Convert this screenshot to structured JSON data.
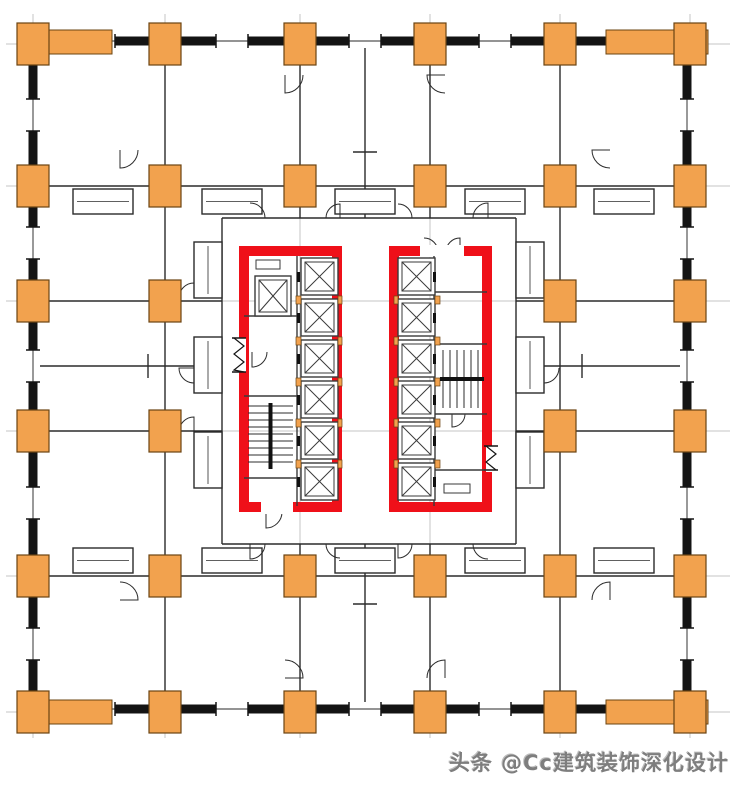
{
  "watermark": {
    "text": "头条 @Cc建筑装饰深化设计"
  },
  "colors": {
    "bg": "#ffffff",
    "wall": "#141414",
    "partition": "#2b2b2b",
    "grid": "#c6c6c6",
    "column_fill": "#f2a24e",
    "column_stroke": "#6b4412",
    "core_red": "#ef1019",
    "detail": "#3a3a3a",
    "stair": "#2e2e2e",
    "watermark_gray": "#7e7e7e"
  },
  "canvas": {
    "w": 734,
    "h": 787
  },
  "grid": {
    "x": [
      33,
      165,
      300,
      430,
      560,
      690
    ],
    "y": [
      44,
      186,
      301,
      431,
      576,
      712
    ],
    "x_extent": [
      6,
      730
    ],
    "y_extent": [
      14,
      738
    ]
  },
  "plan": {
    "outer_wall": {
      "rect": [
        33,
        41,
        654,
        668
      ],
      "thickness": 9
    },
    "windows_h": {
      "xs": [
        99,
        232,
        365,
        495,
        624
      ],
      "y_top": 41,
      "y_bottom": 709,
      "len": 32
    },
    "windows_v": {
      "ys": [
        115,
        243,
        366,
        503,
        644
      ],
      "x_left": 33,
      "x_right": 687,
      "len": 32
    },
    "corner_strips": [
      [
        20,
        30,
        92,
        24
      ],
      [
        606,
        30,
        102,
        24
      ],
      [
        20,
        700,
        92,
        24
      ],
      [
        606,
        700,
        102,
        24
      ]
    ],
    "column_size": [
      32,
      42
    ],
    "columns": [
      [
        165,
        44
      ],
      [
        300,
        44
      ],
      [
        430,
        44
      ],
      [
        560,
        44
      ],
      [
        165,
        712
      ],
      [
        300,
        712
      ],
      [
        430,
        712
      ],
      [
        560,
        712
      ],
      [
        33,
        186
      ],
      [
        33,
        301
      ],
      [
        33,
        431
      ],
      [
        33,
        576
      ],
      [
        690,
        186
      ],
      [
        690,
        301
      ],
      [
        690,
        431
      ],
      [
        690,
        576
      ],
      [
        33,
        44
      ],
      [
        690,
        44
      ],
      [
        33,
        712
      ],
      [
        690,
        712
      ],
      [
        165,
        186
      ],
      [
        300,
        186
      ],
      [
        430,
        186
      ],
      [
        560,
        186
      ],
      [
        165,
        301
      ],
      [
        560,
        301
      ],
      [
        165,
        431
      ],
      [
        560,
        431
      ],
      [
        165,
        576
      ],
      [
        300,
        576
      ],
      [
        430,
        576
      ],
      [
        560,
        576
      ]
    ],
    "partitions": [
      [
        165,
        46,
        165,
        708
      ],
      [
        560,
        46,
        560,
        708
      ],
      [
        300,
        46,
        300,
        218
      ],
      [
        430,
        46,
        430,
        218
      ],
      [
        365,
        46,
        365,
        218
      ],
      [
        300,
        544,
        300,
        708
      ],
      [
        430,
        544,
        430,
        708
      ],
      [
        365,
        544,
        365,
        708
      ],
      [
        36,
        186,
        688,
        186
      ],
      [
        36,
        576,
        688,
        576
      ],
      [
        36,
        301,
        222,
        301
      ],
      [
        36,
        366,
        222,
        366
      ],
      [
        36,
        431,
        222,
        431
      ],
      [
        516,
        301,
        688,
        301
      ],
      [
        516,
        366,
        688,
        366
      ],
      [
        516,
        431,
        688,
        431
      ],
      [
        222,
        218,
        516,
        218
      ],
      [
        222,
        544,
        516,
        544
      ],
      [
        222,
        218,
        222,
        544
      ],
      [
        516,
        218,
        516,
        544
      ],
      [
        353,
        152,
        377,
        152
      ],
      [
        353,
        604,
        377,
        604
      ],
      [
        148,
        354,
        148,
        378
      ],
      [
        582,
        354,
        582,
        378
      ]
    ],
    "pods": [
      [
        73,
        189,
        60,
        25
      ],
      [
        202,
        189,
        60,
        25
      ],
      [
        335,
        189,
        60,
        25
      ],
      [
        465,
        189,
        60,
        25
      ],
      [
        594,
        189,
        60,
        25
      ],
      [
        73,
        548,
        60,
        25
      ],
      [
        202,
        548,
        60,
        25
      ],
      [
        335,
        548,
        60,
        25
      ],
      [
        465,
        548,
        60,
        25
      ],
      [
        594,
        548,
        60,
        25
      ],
      [
        194,
        242,
        28,
        56
      ],
      [
        194,
        337,
        28,
        56
      ],
      [
        194,
        432,
        28,
        56
      ],
      [
        516,
        242,
        28,
        56
      ],
      [
        516,
        337,
        28,
        56
      ],
      [
        516,
        432,
        28,
        56
      ]
    ],
    "door_arcs": [
      [
        250,
        218,
        15,
        0
      ],
      [
        340,
        218,
        14,
        90
      ],
      [
        398,
        218,
        14,
        0
      ],
      [
        488,
        218,
        15,
        90
      ],
      [
        250,
        544,
        15,
        270
      ],
      [
        340,
        544,
        14,
        180
      ],
      [
        398,
        544,
        14,
        270
      ],
      [
        488,
        544,
        15,
        180
      ],
      [
        194,
        298,
        15,
        90
      ],
      [
        194,
        368,
        15,
        180
      ],
      [
        194,
        432,
        15,
        90
      ],
      [
        544,
        298,
        15,
        0
      ],
      [
        544,
        368,
        15,
        270
      ],
      [
        544,
        432,
        15,
        0
      ],
      [
        266,
        512,
        16,
        270
      ],
      [
        424,
        252,
        14,
        0
      ],
      [
        460,
        252,
        14,
        90
      ],
      [
        252,
        352,
        15,
        270
      ],
      [
        452,
        414,
        13,
        270
      ],
      [
        285,
        75,
        18,
        270
      ],
      [
        445,
        75,
        18,
        180
      ],
      [
        120,
        150,
        18,
        270
      ],
      [
        610,
        150,
        18,
        180
      ],
      [
        120,
        600,
        18,
        0
      ],
      [
        610,
        600,
        18,
        90
      ],
      [
        285,
        678,
        18,
        0
      ],
      [
        445,
        678,
        18,
        90
      ]
    ],
    "cores": [
      {
        "name": "left-core",
        "rect": [
          244,
          251,
          93,
          256
        ],
        "inner_lines": [
          [
            297,
            256,
            297,
            506
          ],
          [
            244,
            316,
            297,
            316
          ],
          [
            244,
            396,
            297,
            396
          ],
          [
            244,
            478,
            297,
            478
          ]
        ],
        "gaps": [
          [
            233,
            338,
            13,
            34
          ],
          [
            261,
            501,
            32,
            13
          ]
        ],
        "squiggles": [
          [
            239,
            338,
            239,
            372,
            "v"
          ]
        ],
        "elevators": [
          [
            255,
            276,
            36,
            40
          ],
          [
            301,
            258,
            37,
            37
          ],
          [
            301,
            299,
            37,
            37
          ],
          [
            301,
            340,
            37,
            37
          ],
          [
            301,
            381,
            37,
            37
          ],
          [
            301,
            422,
            37,
            37
          ],
          [
            301,
            463,
            37,
            37
          ]
        ],
        "separators": [
          [
            296,
            296,
            5,
            8
          ],
          [
            296,
            337,
            5,
            8
          ],
          [
            296,
            378,
            5,
            8
          ],
          [
            296,
            419,
            5,
            8
          ],
          [
            296,
            460,
            5,
            8
          ],
          [
            338,
            296,
            4,
            8
          ],
          [
            338,
            337,
            4,
            8
          ],
          [
            338,
            378,
            4,
            8
          ],
          [
            338,
            419,
            4,
            8
          ],
          [
            338,
            460,
            4,
            8
          ]
        ],
        "ticks": [
          [
            297,
            272,
            3,
            10
          ],
          [
            297,
            313,
            3,
            10
          ],
          [
            297,
            354,
            3,
            10
          ],
          [
            297,
            395,
            3,
            10
          ],
          [
            297,
            436,
            3,
            10
          ],
          [
            297,
            477,
            3,
            10
          ]
        ],
        "vents": [
          [
            256,
            260,
            24,
            9
          ]
        ],
        "stair": [
          246,
          400,
          49,
          72,
          "v"
        ]
      },
      {
        "name": "right-core",
        "rect": [
          394,
          251,
          93,
          256
        ],
        "inner_lines": [
          [
            434,
            256,
            434,
            506
          ],
          [
            434,
            292,
            487,
            292
          ],
          [
            434,
            344,
            487,
            344
          ],
          [
            434,
            414,
            487,
            414
          ],
          [
            434,
            470,
            487,
            470
          ]
        ],
        "gaps": [
          [
            420,
            245,
            44,
            12
          ],
          [
            486,
            446,
            12,
            26
          ]
        ],
        "squiggles": [
          [
            491,
            446,
            491,
            470,
            "v"
          ]
        ],
        "elevators": [
          [
            398,
            258,
            37,
            37
          ],
          [
            398,
            299,
            37,
            37
          ],
          [
            398,
            340,
            37,
            37
          ],
          [
            398,
            381,
            37,
            37
          ],
          [
            398,
            422,
            37,
            37
          ],
          [
            398,
            463,
            37,
            37
          ]
        ],
        "separators": [
          [
            394,
            296,
            4,
            8
          ],
          [
            394,
            337,
            4,
            8
          ],
          [
            394,
            378,
            4,
            8
          ],
          [
            394,
            419,
            4,
            8
          ],
          [
            394,
            460,
            4,
            8
          ],
          [
            435,
            296,
            5,
            8
          ],
          [
            435,
            337,
            5,
            8
          ],
          [
            435,
            378,
            5,
            8
          ],
          [
            435,
            419,
            5,
            8
          ],
          [
            435,
            460,
            5,
            8
          ]
        ],
        "ticks": [
          [
            433,
            272,
            3,
            10
          ],
          [
            433,
            313,
            3,
            10
          ],
          [
            433,
            354,
            3,
            10
          ],
          [
            433,
            395,
            3,
            10
          ],
          [
            433,
            436,
            3,
            10
          ],
          [
            433,
            477,
            3,
            10
          ]
        ],
        "vents": [
          [
            444,
            484,
            26,
            9
          ]
        ],
        "stair": [
          437,
          348,
          50,
          62,
          "h"
        ]
      }
    ]
  }
}
